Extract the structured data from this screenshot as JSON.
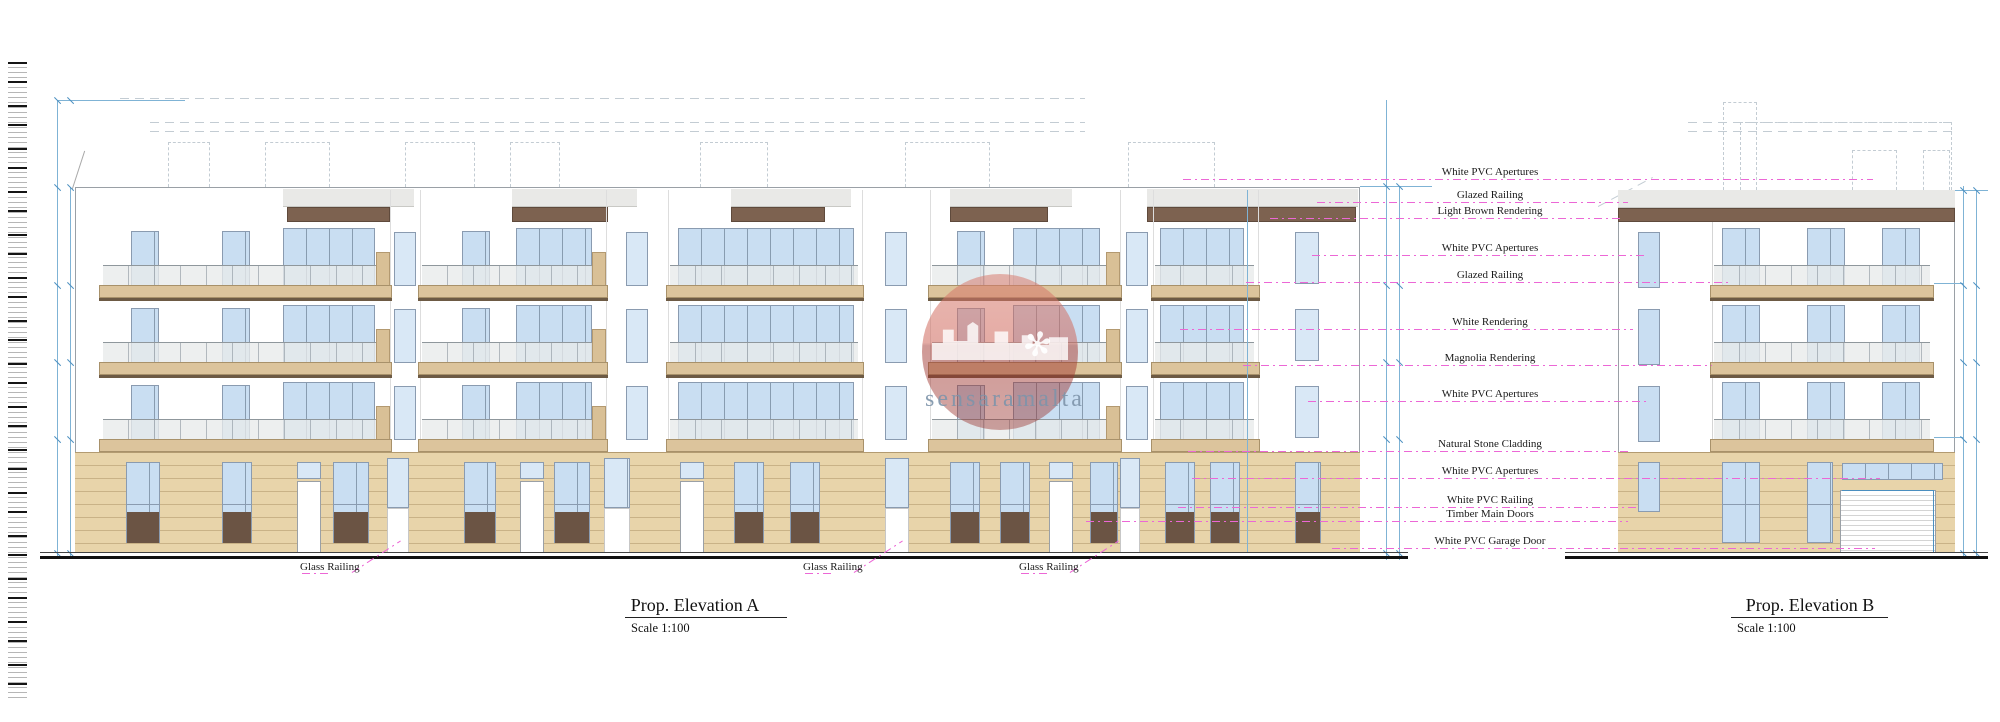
{
  "drawing_type": "architectural-elevation",
  "elevation_a": {
    "title": "Prop. Elevation A",
    "scale": "Scale 1:100"
  },
  "elevation_b": {
    "title": "Prop. Elevation B",
    "scale": "Scale 1:100"
  },
  "annotations": {
    "items": [
      {
        "label": "White PVC Apertures"
      },
      {
        "label": "Glazed Railing"
      },
      {
        "label": "Light Brown Rendering"
      },
      {
        "label": "White PVC Apertures"
      },
      {
        "label": "Glazed Railing"
      },
      {
        "label": "White Rendering"
      },
      {
        "label": "Magnolia Rendering"
      },
      {
        "label": "White PVC Apertures"
      },
      {
        "label": "Natural Stone Cladding"
      },
      {
        "label": "White PVC Apertures"
      },
      {
        "label": "White PVC Railing"
      },
      {
        "label": "Timber Main Doors"
      },
      {
        "label": "White PVC Garage Door"
      }
    ]
  },
  "ground_labels": {
    "items": [
      {
        "label": "Glass Railing"
      },
      {
        "label": "Glass Railing"
      },
      {
        "label": "Glass Railing"
      }
    ]
  },
  "watermark": {
    "text": "sensaramalta"
  },
  "colors": {
    "leader_pink": "#ec67d6",
    "dimension_blue": "#7fb3d5",
    "dimension_blue_dark": "#4b8fc0",
    "glass_blue": "#c9def2",
    "glass_blue_light": "#d9e8f6",
    "stone_tan": "#e8d4aa",
    "stone_line": "#c4ab7c",
    "slab_tan": "#dcc49c",
    "slab_edge": "#a8916a",
    "slab_shadow": "#6d5a44",
    "render_brown": "#7d6250",
    "panel_dark_brown": "#6b5444",
    "band_gray": "#e9e9e7",
    "outline_gray": "#9aa0a6",
    "dash_gray": "#c3ccd3",
    "ground_black": "#111111"
  }
}
